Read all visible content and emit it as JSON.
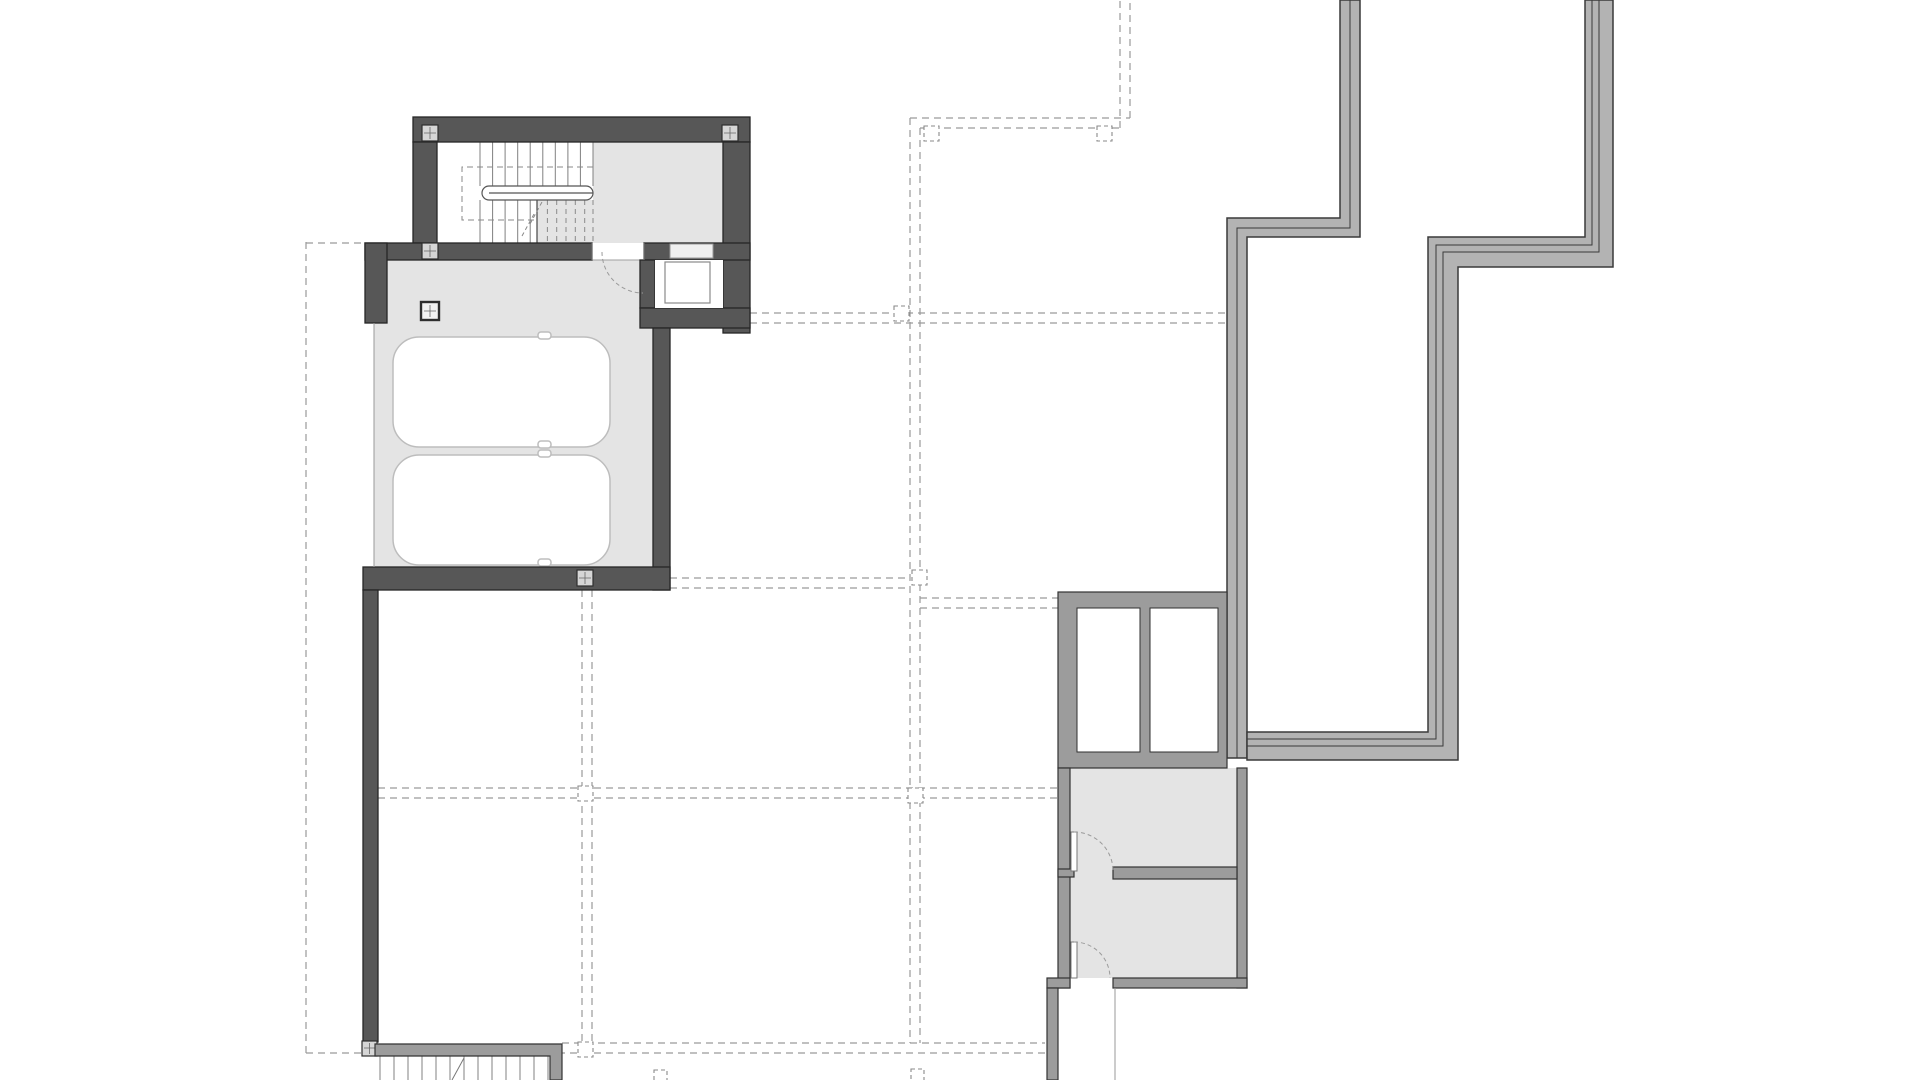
{
  "document": {
    "type": "architectural-floor-plan",
    "view": "top-down plan, garage / lower level",
    "visible_text": [],
    "background": "#ffffff"
  },
  "colors": {
    "wall_dark": "#575757",
    "outline_dark": "#262626",
    "wall_mid": "#9c9c9c",
    "outline_mid": "#333333",
    "terrace": "#b3b3b3",
    "outline_terrace": "#3a3a3a",
    "floor": "#e4e4e4",
    "floor_edge": "#9f9f9f",
    "dash": "#9a9a9a",
    "tread": "#808080",
    "car_outline": "#bdbdbd",
    "column_fill": "#d6d6d6",
    "paper": "#ffffff"
  },
  "plan": {
    "main_building": {
      "rooms": [
        "stair-hall",
        "elevator-shaft",
        "garage"
      ],
      "stair": {
        "upper_flight_treads": 10,
        "lower_flight_treads_solid": 5,
        "lower_flight_treads_dashed": 6,
        "handrail": "U-shaped double rail",
        "opening_outline": "dashed rectangle",
        "break_line": "dashed diagonal"
      },
      "elevator": {
        "car": "inner square outline",
        "door": "recessed in top wall"
      },
      "garage": {
        "parking_spaces": 2,
        "cars": 2,
        "door_opening_side": "left (thin edge line)",
        "pedestrian_door": "dashed quarter-circle swing into garage"
      },
      "columns_with_cross": 6
    },
    "exterior_stair_bottom_left": {
      "steps": 13,
      "side_wall": "L-shaped gray band",
      "direction_tick": true
    },
    "storage_block_lower_right": {
      "window_wells": 2,
      "rooms": 2,
      "doors_with_swing_arcs": 2,
      "partition_walls": 2
    },
    "terrace_retaining_walls": {
      "count": 2,
      "style": "stepped zigzag double-layer gray bands",
      "layers_left": 2,
      "layers_right": 3
    },
    "grid": {
      "style": "paired dashed lines",
      "vertical_pairs": 4,
      "horizontal_pairs": 6,
      "property_line_left": true,
      "dashed_intersection_markers": 9
    }
  }
}
